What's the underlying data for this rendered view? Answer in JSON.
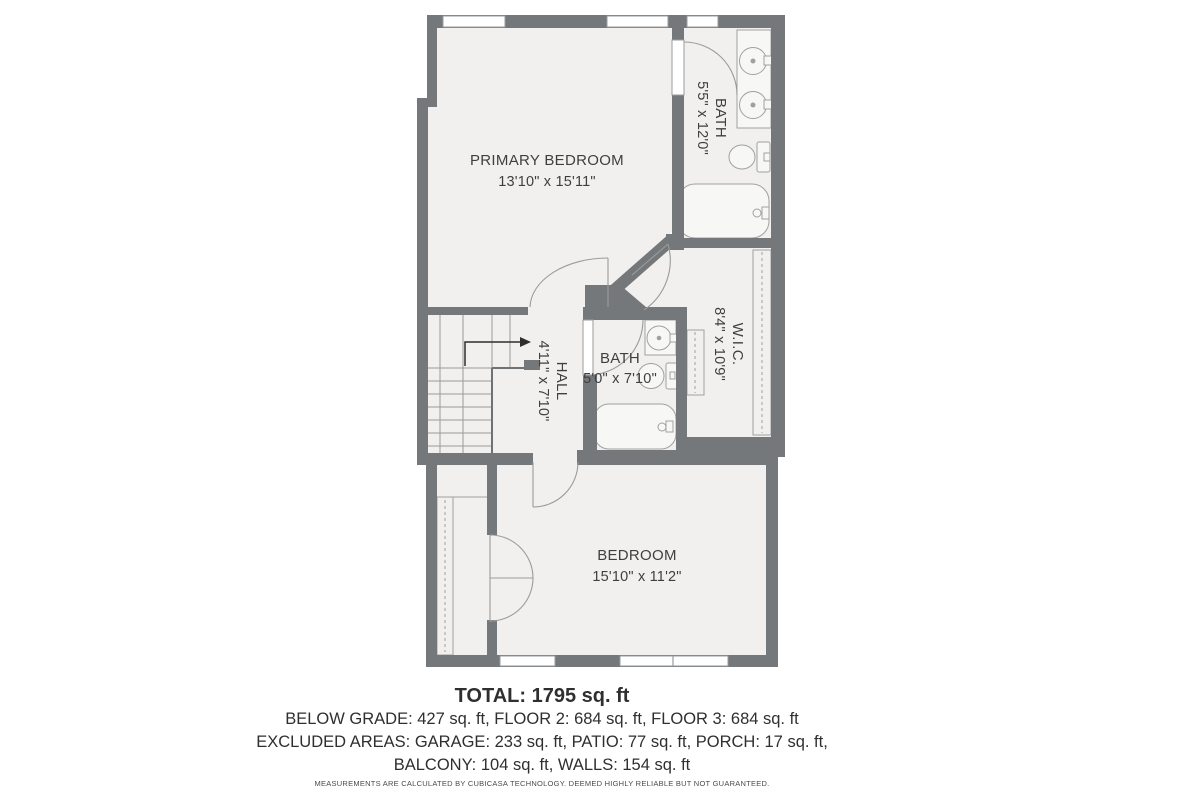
{
  "rooms": {
    "primary_bedroom": {
      "label": "PRIMARY BEDROOM",
      "dimensions": "13'10\" x 15'11\""
    },
    "bath_top": {
      "label": "BATH",
      "dimensions": "5'5\" x 12'0\""
    },
    "wic": {
      "label": "W.I.C.",
      "dimensions": "8'4\" x 10'9\""
    },
    "hall": {
      "label": "HALL",
      "dimensions": "4'11\" x 7'10\""
    },
    "bath_mid": {
      "label": "BATH",
      "dimensions": "5'0\" x 7'10\""
    },
    "bedroom": {
      "label": "BEDROOM",
      "dimensions": "15'10\" x 11'2\""
    }
  },
  "summary": {
    "total": "TOTAL: 1795 sq. ft",
    "line2": "BELOW GRADE: 427 sq. ft, FLOOR 2: 684 sq. ft, FLOOR 3: 684 sq. ft",
    "line3": "EXCLUDED AREAS: GARAGE: 233 sq. ft, PATIO: 77 sq. ft, PORCH: 17 sq. ft,",
    "line4": "BALCONY: 104 sq. ft, WALLS: 154 sq. ft",
    "disclaimer": "MEASUREMENTS ARE CALCULATED BY CUBICASA TECHNOLOGY. DEEMED HIGHLY RELIABLE BUT NOT GUARANTEED."
  },
  "colors": {
    "wall": "#75787b",
    "floor": "#f1f0ee",
    "fixture_stroke": "#a0a0a0",
    "text": "#3f3f3f",
    "background": "#ffffff"
  }
}
